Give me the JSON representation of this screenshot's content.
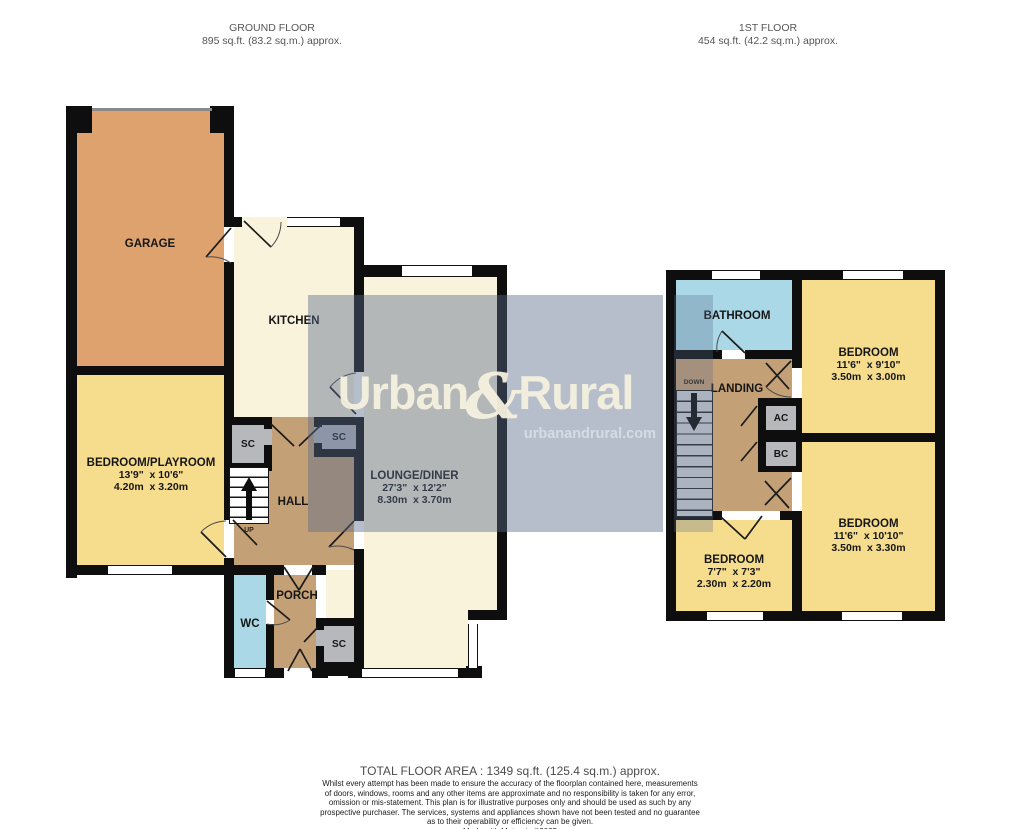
{
  "header": {
    "ground_floor": {
      "title": "GROUND FLOOR",
      "area": "895 sq.ft. (83.2 sq.m.) approx."
    },
    "first_floor": {
      "title": "1ST FLOOR",
      "area": "454 sq.ft. (42.2 sq.m.) approx."
    }
  },
  "watermark": {
    "brand_left": "Urban",
    "brand_amp": "&",
    "brand_right": "Rural",
    "website": "urbanandrural.com"
  },
  "rooms": {
    "garage": {
      "name": "GARAGE"
    },
    "kitchen": {
      "name": "KITCHEN"
    },
    "bedroom_playroom": {
      "name": "BEDROOM/PLAYROOM",
      "size_imperial": "13'9\"  x 10'6\"",
      "size_metric": "4.20m  x 3.20m"
    },
    "lounge_diner": {
      "name": "LOUNGE/DINER",
      "size_imperial": "27'3\"  x 12'2\"",
      "size_metric": "8.30m  x 3.70m"
    },
    "hall": {
      "name": "HALL"
    },
    "porch": {
      "name": "PORCH"
    },
    "wc": {
      "name": "WC"
    },
    "sc_hall_left": {
      "name": "SC"
    },
    "sc_hall_right": {
      "name": "SC"
    },
    "sc_porch": {
      "name": "SC"
    },
    "stairs_up": {
      "name": "UP"
    },
    "bathroom": {
      "name": "BATHROOM"
    },
    "landing": {
      "name": "LANDING"
    },
    "stairs_down": {
      "name": "DOWN"
    },
    "ac": {
      "name": "AC"
    },
    "bc": {
      "name": "BC"
    },
    "bedroom_front": {
      "name": "BEDROOM",
      "size_imperial": "11'6\"  x 9'10\"",
      "size_metric": "3.50m  x 3.00m"
    },
    "bedroom_rear": {
      "name": "BEDROOM",
      "size_imperial": "11'6\"  x 10'10\"",
      "size_metric": "3.50m  x 3.30m"
    },
    "bedroom_small": {
      "name": "BEDROOM",
      "size_imperial": "7'7\"  x 7'3\"",
      "size_metric": "2.30m  x 2.20m"
    }
  },
  "footer": {
    "total_area": "TOTAL FLOOR AREA : 1349 sq.ft. (125.4 sq.m.) approx.",
    "disclaimer": [
      "Whilst every attempt has been made to ensure the accuracy of the floorplan contained here, measurements",
      "of doors, windows, rooms and any other items are approximate and no responsibility is taken for any error,",
      "omission or mis-statement. This plan is for illustrative purposes only and should be used as such by any",
      "prospective purchaser. The services, systems and appliances shown have not been tested and no guarantee",
      "as to their operability or efficiency can be given."
    ],
    "credit": "Made with Metropix ©2025"
  },
  "colors": {
    "wall": "#0e0e0e",
    "garage": "#dda26e",
    "bedroom_yellow": "#f6dd8e",
    "cream": "#faf3dc",
    "hall_tan": "#c4a077",
    "bathroom_blue": "#aad8e6",
    "closet_gray": "#b7b8bc",
    "first_floor_stairs": "#ced2d8",
    "watermark_overlay": "#586c8a",
    "watermark_text": "#f5f0de"
  }
}
